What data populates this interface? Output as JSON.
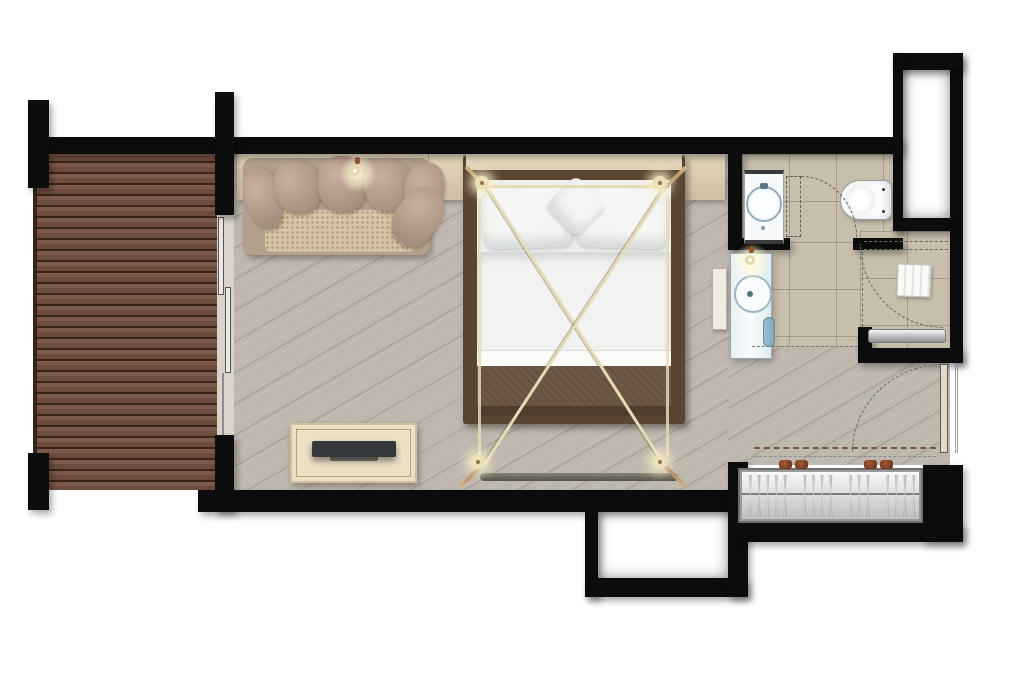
{
  "diagram": {
    "label": "Hotel guest room floor plan, top view",
    "type": "floor-plan"
  },
  "palette": {
    "background": "#ffffff",
    "wall_black": "#0c0c0c",
    "deck_wood": "#6d4a3c",
    "bedroom_wood": "#beb7ae",
    "bathroom_tile": "#c8beac",
    "ledge_cream": "#ddcfb5",
    "sofa_fabric": "#b3a08c",
    "seat_weave": "#d6c2a4",
    "bed_frame_wood": "#5a4533",
    "bedding_white": "#f2f3f0",
    "canopy_cream": "#e7dbb7",
    "warm_glow": "#fff9d6",
    "dresser_cream": "#ece1c6",
    "tv_dark": "#35383a",
    "wardrobe_metal": "#d8d8d8",
    "sanitary_white": "#f7f9fa",
    "basin_accent": "#93aebb",
    "towel_blue": "#9fc0d0",
    "bench_steel": "#9c9c9c",
    "knob_brown": "#84412a"
  },
  "rooms": [
    {
      "id": "deck",
      "name": "deck-terrace",
      "floor": "dark wood decking"
    },
    {
      "id": "bedroom",
      "name": "bedroom-living-area",
      "floor": "light wood planks"
    },
    {
      "id": "wc",
      "name": "toilet-room",
      "floor": "beige tile"
    },
    {
      "id": "shower",
      "name": "shower-room",
      "floor": "beige tile"
    },
    {
      "id": "entry",
      "name": "entry-hall",
      "floor": "light wood planks"
    },
    {
      "id": "shaft_top",
      "name": "service-shaft-top-right",
      "floor": "void"
    },
    {
      "id": "shaft_bottom",
      "name": "service-shaft-bottom-center",
      "floor": "void"
    }
  ],
  "furniture": [
    {
      "name": "sofa",
      "cushion_count": 6
    },
    {
      "name": "console-ledge"
    },
    {
      "name": "nightstand-left"
    },
    {
      "name": "nightstand-right"
    },
    {
      "name": "canopy-four-poster-bed",
      "post_count": 4,
      "pillow_count": 3
    },
    {
      "name": "bed-foot-bench"
    },
    {
      "name": "tv-dresser"
    },
    {
      "name": "television"
    },
    {
      "name": "wardrobe",
      "hanger_count": 16,
      "knob_count": 4
    }
  ],
  "fixtures": [
    {
      "name": "wc-washbasin"
    },
    {
      "name": "toilet"
    },
    {
      "name": "vanity-washbasin"
    },
    {
      "name": "vanity-shelf"
    },
    {
      "name": "hand-towel"
    },
    {
      "name": "shower-bench"
    },
    {
      "name": "shower-towel"
    },
    {
      "name": "wall-sconce-sofa"
    },
    {
      "name": "wall-sconce-vanity"
    },
    {
      "name": "canopy-post-lights",
      "count": 4
    }
  ],
  "doors": [
    {
      "name": "sliding-glass-door",
      "location": "deck-to-bedroom",
      "panel_count": 2
    },
    {
      "name": "wc-door",
      "swing": "quarter-arc"
    },
    {
      "name": "shower-door",
      "swing": "quarter-arc"
    },
    {
      "name": "entry-door",
      "swing": "quarter-arc"
    }
  ]
}
